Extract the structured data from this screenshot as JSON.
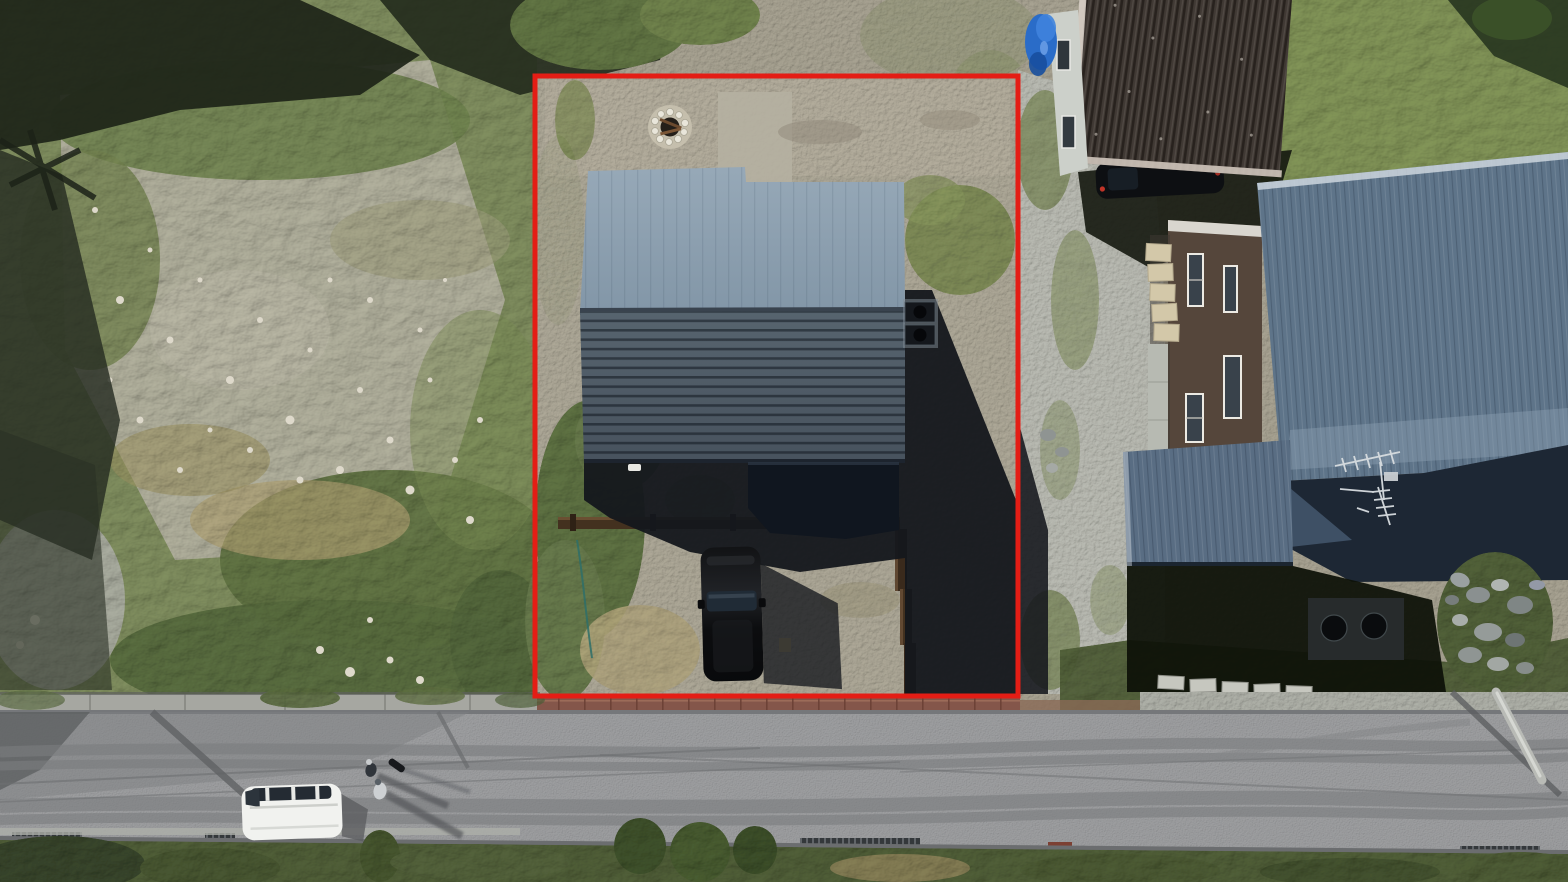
{
  "scene": {
    "type": "aerial-drone-photo",
    "description": "Top-down drone photograph of a residential parcel outlined with a red boundary rectangle. Inside the boundary: a house with a two-tone gray standing-seam metal roof, a gravel yard with a stone fire pit, a wooden retaining wall and a black minivan parked beside the entry. Left of the parcel is an overgrown rocky vacant lot. Right of it a gravel driveway leads to neighbouring houses: one with a dark-brown corrugated roof and a blue tarp, one large house with a slate-blue metal roof carrying a TV antenna, plus a stone walkway, boulder pile and concrete parking blocks. An asphalt road with drainage grates, tire marks, pole shadows, a parked white van and two pedestrians crosses the bottom of the frame.",
    "annotation": {
      "kind": "property-boundary-rectangle",
      "color_key": "annotation_red",
      "x": 535,
      "y": 76,
      "width": 483,
      "height": 620
    },
    "objects": [
      "vacant rocky lot",
      "tree shadows",
      "pylon shadow",
      "boundary red rectangle",
      "fire pit with stone ring",
      "target house two-tone gray metal roof",
      "entry porch roof",
      "air-conditioner pad",
      "black minivan",
      "wooden retaining wall",
      "garden rope",
      "gravel yard",
      "red brick paver strip",
      "neighbour house with brown corrugated roof",
      "blue tarp",
      "car parked under eave",
      "brown wall house with white windows",
      "stone paver walkway",
      "concrete path",
      "large neighbour house slate-blue roof",
      "tv-antenna",
      "annex blue roof",
      "building shadow",
      "utility pad with round covers",
      "boulder pile",
      "concrete parking blocks",
      "green lawn",
      "asphalt road",
      "drainage grates",
      "tire marks",
      "wire shadows",
      "utility pole",
      "white van",
      "two pedestrians",
      "roadside vegetation"
    ]
  },
  "colors": {
    "annotation_red": "#e41d15",
    "roof_sunlit": "#8da0b0",
    "roof_shaded": "#4e5b68",
    "entry_roof": "#10161f",
    "house_shadow": "#14171c",
    "gravel_base": "#a19c8c",
    "gravel_cool": "#b5b8b1",
    "lot_green": "#7c8a5c",
    "lawn_green": "#7e9055",
    "grass_dark": "#4e5c36",
    "asphalt": "#97989a",
    "van_white": "#f1f2ef",
    "car_black": "#0e0f11",
    "wood_brown": "#43311f",
    "brick_red": "#84564a",
    "neighbor_roof_brown": "#403934",
    "neighbor_roof_blue": "#5e7489",
    "neighbor_roof_blue_dark": "#1d2734",
    "annex_roof_blue": "#596d83",
    "tarp_blue": "#2a6cc8",
    "white_trim": "#d6cdc4",
    "stone_pale": "#d3c8a9"
  }
}
